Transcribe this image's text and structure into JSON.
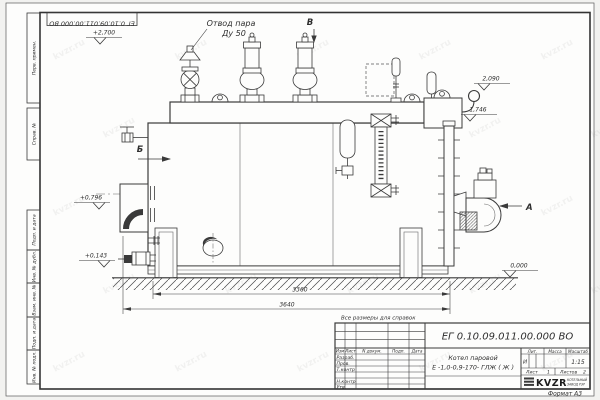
{
  "document": {
    "watermark": "kvzr.ru",
    "note": "Все размеры для справок",
    "format_label": "Формат  А3",
    "stamp_rotated": "ЕГ 0.10.09.011.00.000 ВО"
  },
  "side_column": {
    "perv_primen": "Перв. примен.",
    "sprav_no": "Справ. №",
    "podp_data_1": "Подп. и дата",
    "inv_dubl": "Инв. № дубл.",
    "vzam_inv": "Взам. инв. №",
    "podp_data_2": "Подп. и дата",
    "inv_podl": "Инв. № подл."
  },
  "callout": {
    "line1": "Отвод пара",
    "line2": "Ду 50"
  },
  "views": {
    "a": "А",
    "b": "Б",
    "v": "В"
  },
  "elevations": {
    "top": "+2,700",
    "chimney": "2,090",
    "hook": "1,746",
    "feed": "+0,796",
    "low": "+0,143",
    "ground": "0,000"
  },
  "dimensions": {
    "inner": "3360",
    "overall": "3640"
  },
  "title_block": {
    "doc_number": "ЕГ 0.10.09.011.00.000  ВО",
    "name_line1": "Котел паровой",
    "name_line2": "Е -1,0-0,9-170- ГЛЖ ( Ж )",
    "col_izm": "Изм",
    "col_list": "Лист",
    "col_ndoc": "N докум.",
    "col_podp": "Подп.",
    "col_data": "Дата",
    "row_razrab": "Разраб.",
    "row_prov": "Пров.",
    "row_tkontr": "Т.контр",
    "row_nkontr": "Н.контр",
    "row_utv": "Утв.",
    "lit_header": "Лит.",
    "mass_header": "Масса",
    "scale_header": "Масштаб",
    "lit_value": "И",
    "scale_value": "1:15",
    "sheet_label": "Лист",
    "sheet_number": "1",
    "sheets_label": "Листов",
    "sheets_total": "2",
    "logo_text": "KVZR",
    "logo_caption1": "КОТЕЛЬНЫЙ",
    "logo_caption2": "ЗАВОД РЭР"
  }
}
